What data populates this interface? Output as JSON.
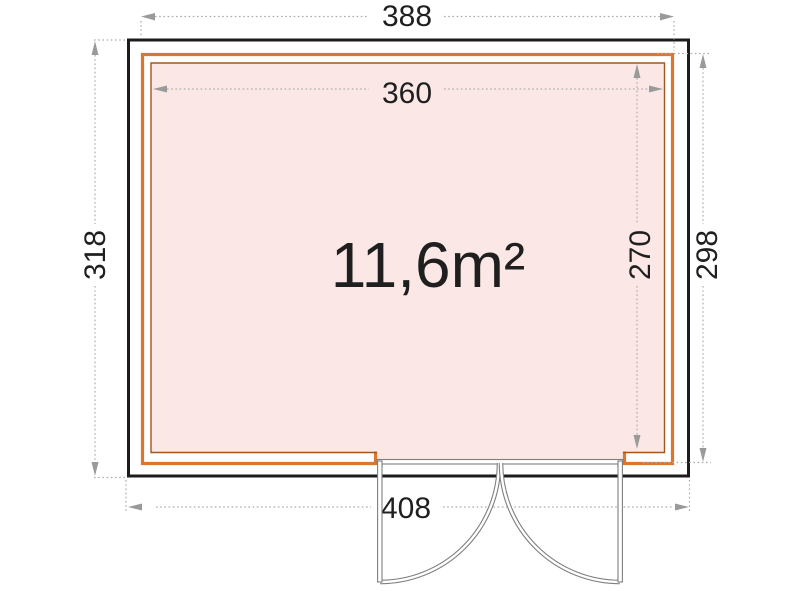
{
  "diagram": {
    "type": "floor-plan",
    "area_label": "11,6m²",
    "dimensions": {
      "top_outer": "388",
      "top_inner": "360",
      "left_height": "318",
      "right_outer": "298",
      "right_inner": "270",
      "bottom_width": "408"
    }
  },
  "colors": {
    "wall": "#1c1c1c",
    "frame_orange": "#df752c",
    "frame_inner": "#a2561d",
    "floor_pink": "#fae7e6",
    "dim_line": "#acacac",
    "dim_arrow": "#9a9a9a",
    "dim_text": "#1f1f1f",
    "door_line": "#7f7f7f"
  }
}
